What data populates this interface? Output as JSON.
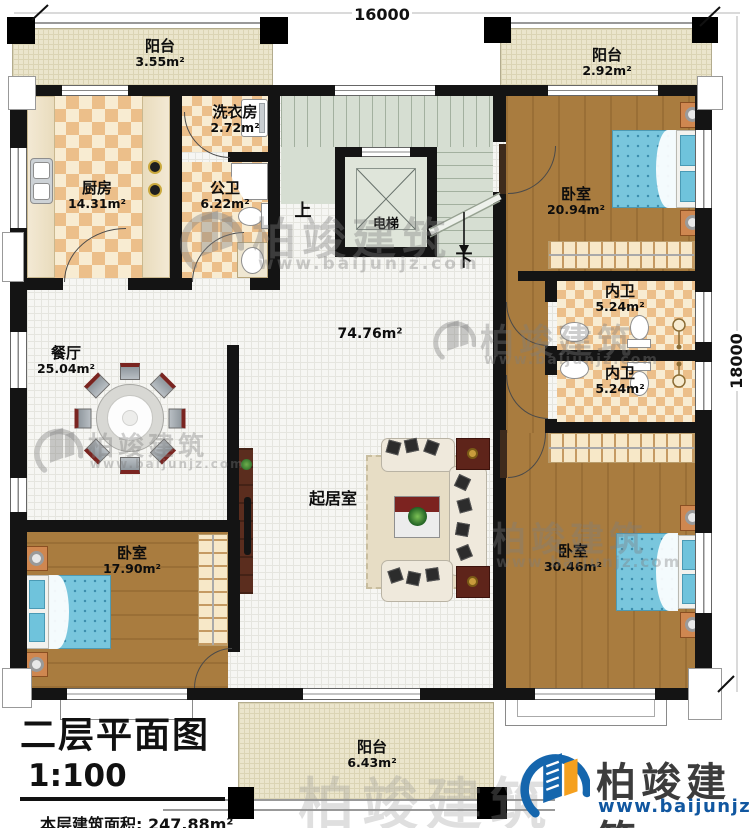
{
  "plan": {
    "dim_top": "16000",
    "dim_right": "18000",
    "stair_up": "上",
    "stair_down": "下",
    "hall_area": "74.76m²",
    "living_label": "起居室"
  },
  "rooms": {
    "balcony_tl": {
      "name": "阳台",
      "area": "3.55m²"
    },
    "balcony_tr": {
      "name": "阳台",
      "area": "2.92m²"
    },
    "balcony_bottom": {
      "name": "阳台",
      "area": "6.43m²"
    },
    "kitchen": {
      "name": "厨房",
      "area": "14.31m²"
    },
    "laundry": {
      "name": "洗衣房",
      "area": "2.72m²"
    },
    "public_bath": {
      "name": "公卫",
      "area": "6.22m²"
    },
    "elevator": {
      "name": "电梯"
    },
    "bedroom_tr": {
      "name": "卧室",
      "area": "20.94m²"
    },
    "bath_1": {
      "name": "内卫",
      "area": "5.24m²"
    },
    "bath_2": {
      "name": "内卫",
      "area": "5.24m²"
    },
    "dining": {
      "name": "餐厅",
      "area": "25.04m²"
    },
    "bedroom_bl": {
      "name": "卧室",
      "area": "17.90m²"
    },
    "bedroom_br": {
      "name": "卧室",
      "area": "30.46m²"
    }
  },
  "title_block": {
    "title": "二层平面图",
    "scale": "1:100",
    "area_line": "本层建筑面积: 247.88m²",
    "floor_height": "层高: 3.2m"
  },
  "brand": {
    "name": "柏竣建筑",
    "url": "www.baijunjz.com"
  },
  "watermark": {
    "name": "柏竣建筑",
    "url": "www.baijunjz.com"
  }
}
